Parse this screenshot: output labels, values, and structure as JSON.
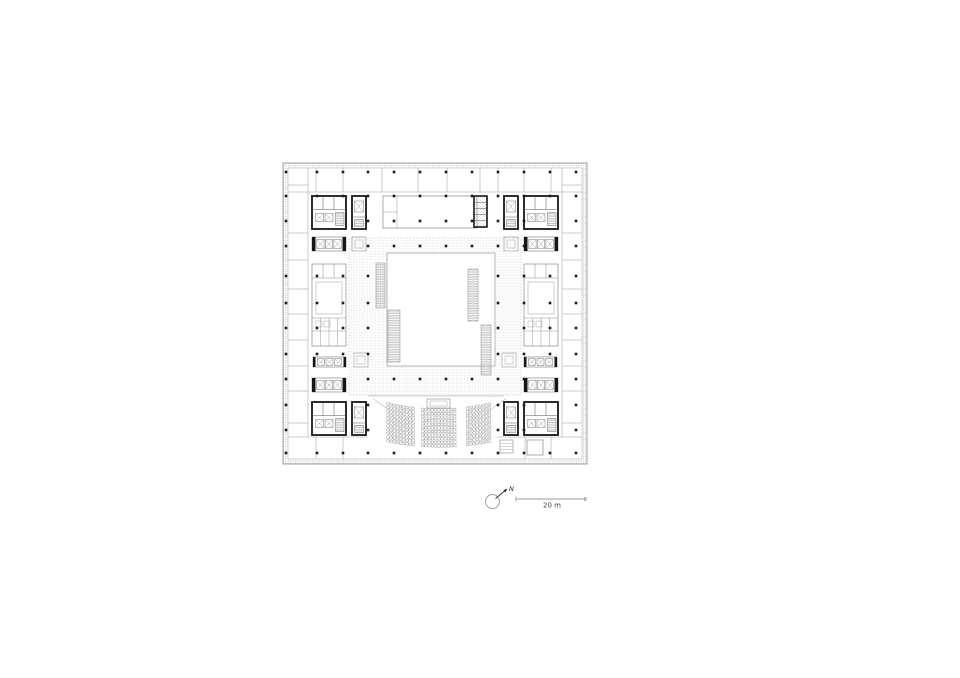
{
  "annotations": {
    "north_label": "N",
    "scale_label": "20 m"
  },
  "colors": {
    "ink": "#1c1c1c",
    "core_wall": "#161616",
    "mid": "#555555",
    "light": "#8f8f8f",
    "faint": "#b5b5b5",
    "tile_line": "#d9d9d9",
    "wall_hatch": "#c9c9c9",
    "paper": "#ffffff"
  },
  "plan": {
    "outer": {
      "x": 283,
      "y": 163,
      "w": 304,
      "h": 301,
      "inset": 5
    },
    "grid": {
      "xs": [
        286,
        317,
        343,
        368,
        394,
        420,
        446,
        472,
        498,
        524,
        550,
        576
      ],
      "ys": [
        172,
        196,
        221,
        246,
        276,
        303,
        328,
        354,
        379,
        405,
        430,
        453
      ],
      "dot_size": 2.6
    },
    "atrium": {
      "corridor": {
        "x": 349,
        "y": 238,
        "w": 172,
        "h": 157
      },
      "void": {
        "x": 387,
        "y": 253,
        "w": 108,
        "h": 113
      }
    },
    "escalators": [
      {
        "x": 376,
        "y": 263,
        "w": 9,
        "h": 45
      },
      {
        "x": 388,
        "y": 310,
        "w": 12,
        "h": 52
      },
      {
        "x": 468,
        "y": 269,
        "w": 10,
        "h": 52
      },
      {
        "x": 481,
        "y": 325,
        "w": 10,
        "h": 50
      }
    ],
    "cores_a": [
      {
        "x": 312,
        "y": 196
      },
      {
        "x": 524,
        "y": 196
      },
      {
        "x": 312,
        "y": 402
      },
      {
        "x": 524,
        "y": 402
      }
    ],
    "core_a_size": {
      "w": 34,
      "h": 33
    },
    "cores_b": [
      {
        "x": 352,
        "y": 196
      },
      {
        "x": 504,
        "y": 196
      },
      {
        "x": 352,
        "y": 402
      },
      {
        "x": 504,
        "y": 402
      }
    ],
    "core_b_size": {
      "w": 14,
      "h": 33
    },
    "elevator_banks": [
      {
        "x": 312,
        "y": 237
      },
      {
        "x": 524,
        "y": 237
      },
      {
        "x": 312,
        "y": 378
      },
      {
        "x": 524,
        "y": 378
      }
    ],
    "bank_size": {
      "w": 34,
      "h": 14,
      "cabs": 3
    },
    "mid_banks": [
      {
        "x": 313,
        "y": 357
      },
      {
        "x": 524,
        "y": 357
      }
    ],
    "mid_bank_size": {
      "w": 33,
      "h": 10,
      "cabs": 3
    },
    "service_shaft": {
      "x": 474,
      "y": 196,
      "w": 13,
      "h": 31,
      "cells": 5
    },
    "side_clusters": [
      {
        "x": 312,
        "y": 264
      },
      {
        "x": 524,
        "y": 264
      }
    ],
    "side_cluster_size": {
      "w": 34,
      "h": 82
    },
    "meeting_room": {
      "x": 383,
      "y": 196,
      "w": 94,
      "h": 32,
      "split_x": 397,
      "split_y": 212
    },
    "small_rooms": [
      {
        "x": 352,
        "y": 237
      },
      {
        "x": 504,
        "y": 237
      },
      {
        "x": 354,
        "y": 353
      },
      {
        "x": 502,
        "y": 353
      }
    ],
    "small_room_size": {
      "w": 14,
      "h": 14
    },
    "storage_squares": {
      "hatched": {
        "x": 500,
        "y": 440,
        "w": 13,
        "h": 13
      },
      "plain": {
        "x": 527,
        "y": 440,
        "w": 16,
        "h": 15
      }
    },
    "partitions": {
      "top": {
        "back_y": 192,
        "x1": 288,
        "x2": 582,
        "y0": 168,
        "ticks_x": [
          316,
          343,
          382,
          418,
          447,
          480,
          498,
          524,
          551
        ]
      },
      "left": {
        "back_x": 308,
        "y1": 168,
        "y2": 437,
        "x0": 288,
        "ticks_y": [
          185,
          233,
          260,
          289,
          314,
          340,
          366,
          391,
          423
        ]
      },
      "right": {
        "back_x": 562,
        "y1": 168,
        "y2": 437,
        "x0": 582,
        "ticks_y": [
          185,
          233,
          260,
          289,
          314,
          340,
          366,
          391,
          423
        ]
      },
      "bottom": {
        "back_y": 437,
        "segs": [
          [
            288,
            368
          ],
          [
            497,
            582
          ]
        ],
        "y1": 459,
        "ticks_x": [
          316,
          343,
          525,
          551
        ]
      }
    },
    "auditorium": {
      "cx": 439.5,
      "cy": 190,
      "r0": 220,
      "rows": 11,
      "r_step": 3.6,
      "half_width": 51.5,
      "aisle_offset": [
        18,
        25
      ],
      "seat": 2.5,
      "seat_step": 3.2,
      "top_line": {
        "x1": 368,
        "y": 396,
        "x2": 504
      },
      "stage": {
        "x": 427,
        "y": 399,
        "w": 23,
        "h": 9
      },
      "stage_inner": {
        "x": 430,
        "y": 401,
        "w": 17,
        "h": 5
      },
      "wing_lines": [
        [
          389,
          410,
          373,
          398.5
        ],
        [
          490,
          410,
          506,
          398.5
        ]
      ]
    },
    "dot_excludes_extra": [
      {
        "x": 387,
        "y": 253,
        "w": 108,
        "h": 113
      },
      {
        "x": 388,
        "y": 398,
        "w": 104,
        "h": 52
      }
    ],
    "north": {
      "cx": 492.5,
      "cy": 501.5,
      "r": 7,
      "tail": [
        495.5,
        498.5
      ],
      "tip": [
        507,
        489
      ]
    },
    "scalebar": {
      "x1": 516,
      "x2": 586,
      "y": 499,
      "tick": 5,
      "label_x": 552,
      "label_y": 507.5
    }
  }
}
